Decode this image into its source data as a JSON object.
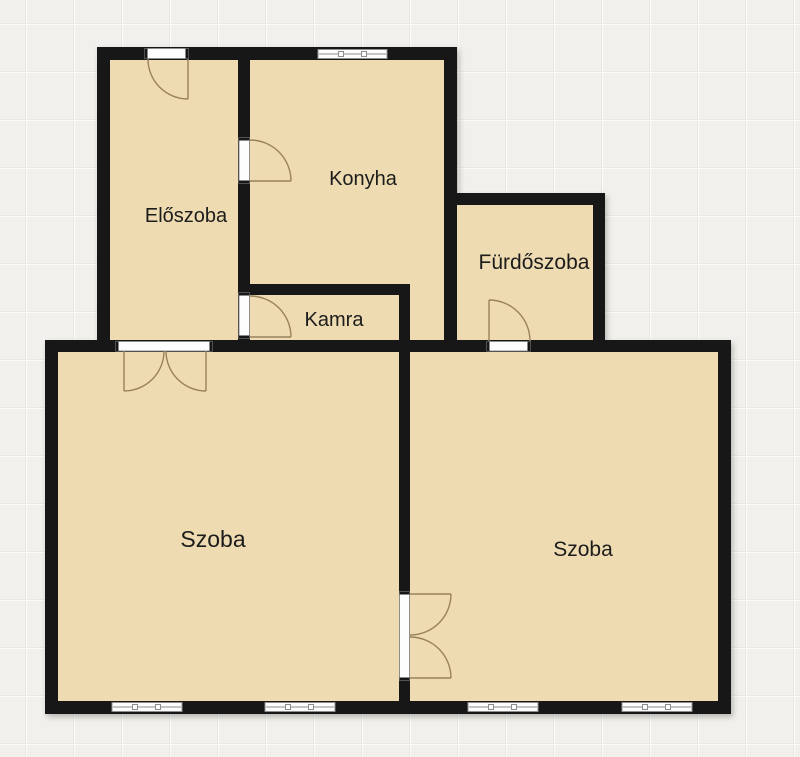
{
  "colors": {
    "background": "#f1f0ec",
    "grid_line_light": "#fafaf7",
    "grid_line_dark": "#e8e7e3",
    "wall": "#171717",
    "room_fill": "#eedbb1",
    "opening_fill": "#fdfdfd",
    "opening_stroke": "#8d8d8d",
    "door_swing": "#98825d",
    "label_color": "#1c1c1c"
  },
  "rooms": [
    {
      "id": "eloszoba",
      "label": "Előszoba"
    },
    {
      "id": "konyha",
      "label": "Konyha"
    },
    {
      "id": "furdoszoba",
      "label": "Fürdőszoba"
    },
    {
      "id": "kamra",
      "label": "Kamra"
    },
    {
      "id": "szoba_left",
      "label": "Szoba"
    },
    {
      "id": "szoba_right",
      "label": "Szoba"
    }
  ]
}
